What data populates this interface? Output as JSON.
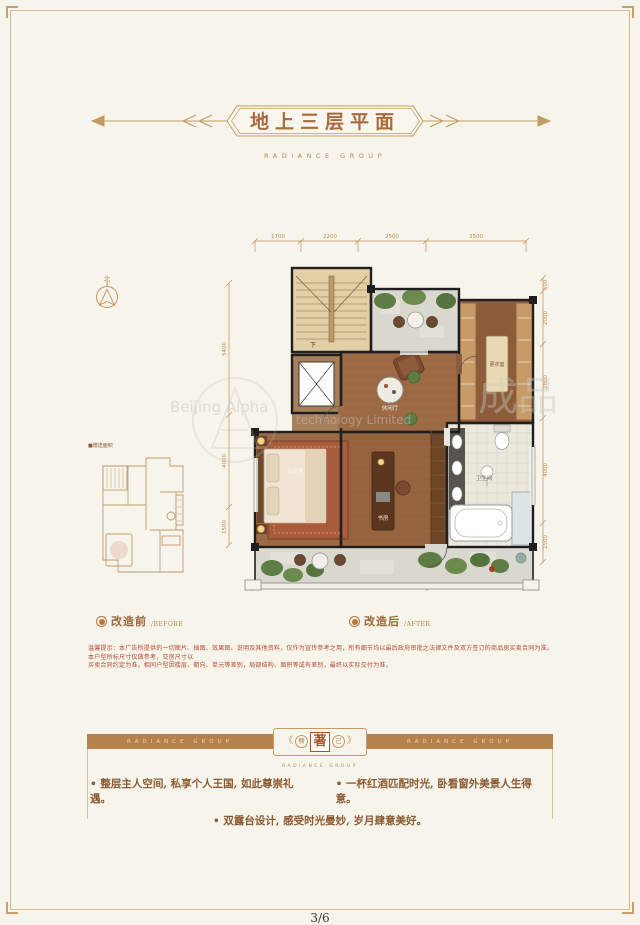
{
  "page": {
    "background": "#f6f4eb",
    "accent_gold": "#c2945f",
    "disclaimer_red": "#b5492f",
    "banner_brown": "#b5824e",
    "page_number": "3/6"
  },
  "header": {
    "title": "地上三层平面",
    "subtitle": "RADIANCE GROUP"
  },
  "compass": {
    "north_label": "北"
  },
  "thumbnail": {
    "caption": "■赠送面积"
  },
  "plan": {
    "room_labels": {
      "stairs_down": "下",
      "lounge": "休闲厅",
      "dressing": "更衣室",
      "master_bedroom": "主卧室",
      "study": "书房",
      "bathroom": "卫生间"
    },
    "dims_top": [
      "1700",
      "2200",
      "2500",
      "3500"
    ],
    "dims_bottom": [
      "6400",
      "3500"
    ],
    "dims_left": [
      "5400",
      "4000",
      "1500"
    ],
    "dims_right": [
      "500",
      "2000",
      "2800",
      "4000",
      "1500"
    ]
  },
  "markers": {
    "before_cn": "改造前",
    "before_en": "/BEFORE",
    "after_cn": "改造后",
    "after_en": "/AFTER"
  },
  "watermark": {
    "brand_en_left": "Beijing Alpha",
    "brand_en_right": "technology Limited",
    "brand_cn": "成品"
  },
  "disclaimer": {
    "line1": "温馨提示：本广告所提供的一切图片、插图、效果图、说明及其他资料，仅作为宣传参考之用，所有细节均以最后政府审批之法律文件及双方签订的商品房买卖合同为准。本户型所标尺寸仅做参考，交房尺寸以",
    "line2": "买卖合同约定为准。相同户型因楼层、朝向、单元等差别，局部结构、面积等或有差别，最终以实际交付为准。"
  },
  "banner": {
    "left_text": "RADIANCE GROUP",
    "right_text": "RADIANCE GROUP",
    "bracket_left": "《",
    "bracket_right": "》",
    "seal_left": "畅",
    "seal_center": "著",
    "seal_right": "己",
    "caption": "RADIANCE GROUP"
  },
  "selling_points": {
    "row1_a": "• 整层主人空间, 私享个人王国, 如此尊崇礼遇。",
    "row1_b": "• 一杯红酒匹配时光, 卧看窗外美景人生得意。",
    "row2": "• 双露台设计, 感受时光曼妙, 岁月肆意美好。"
  }
}
